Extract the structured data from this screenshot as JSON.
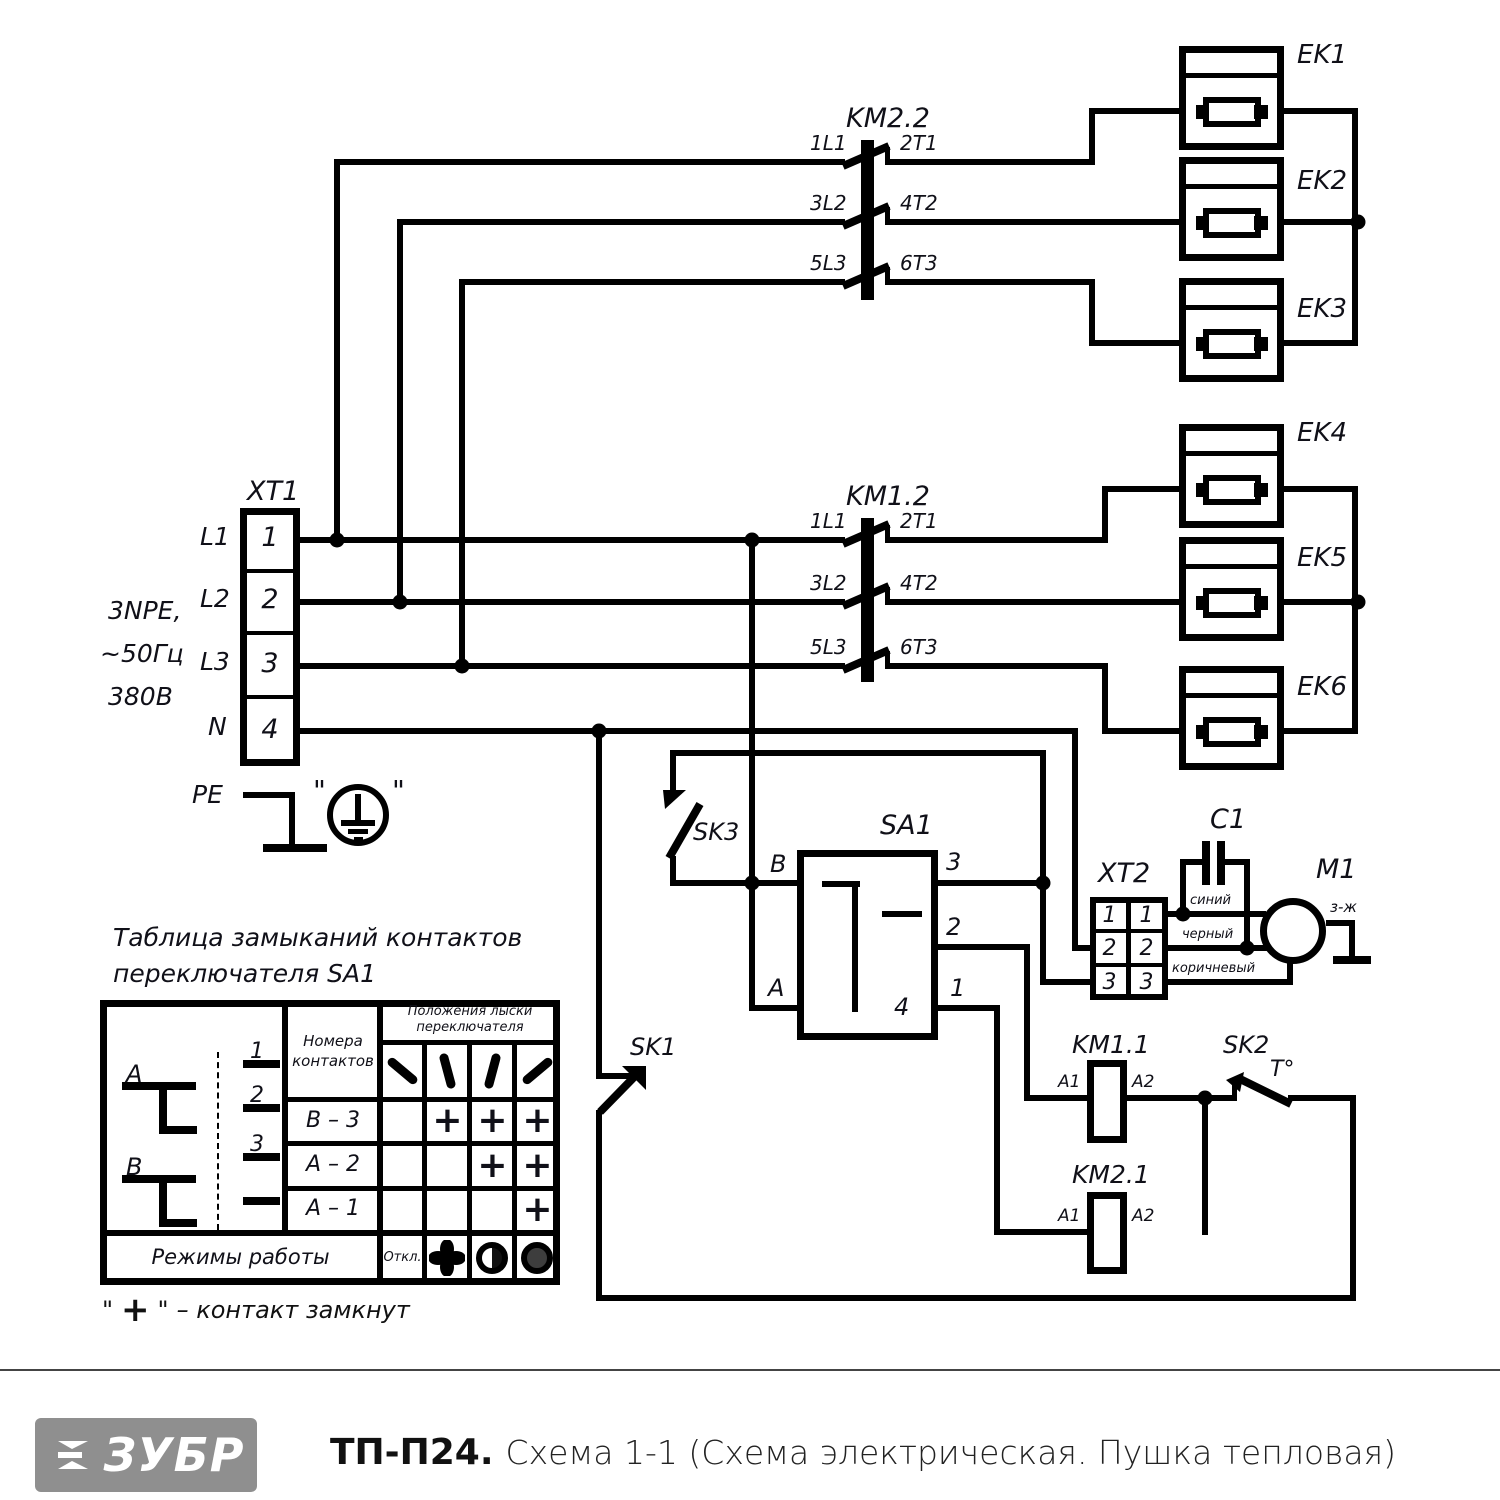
{
  "schematic": {
    "xt1": {
      "label": "XT1",
      "pe": "PE",
      "supply_lines": [
        "3NPE,",
        "~50Гц",
        "380В"
      ],
      "terminals": [
        {
          "phase": "L1",
          "num": "1"
        },
        {
          "phase": "L2",
          "num": "2"
        },
        {
          "phase": "L3",
          "num": "3"
        },
        {
          "phase": "N",
          "num": "4"
        }
      ]
    },
    "km22": {
      "label": "KM2.2",
      "contacts": [
        {
          "in": "1L1",
          "out": "2T1"
        },
        {
          "in": "3L2",
          "out": "4T2"
        },
        {
          "in": "5L3",
          "out": "6T3"
        }
      ]
    },
    "km12": {
      "label": "KM1.2",
      "contacts": [
        {
          "in": "1L1",
          "out": "2T1"
        },
        {
          "in": "3L2",
          "out": "4T2"
        },
        {
          "in": "5L3",
          "out": "6T3"
        }
      ]
    },
    "heaters": [
      "EK1",
      "EK2",
      "EK3",
      "EK4",
      "EK5",
      "EK6"
    ],
    "sa1": {
      "label": "SA1",
      "pin_b": "B",
      "pin_a": "A",
      "pin3": "3",
      "pin2": "2",
      "pin1": "1",
      "pin4": "4"
    },
    "sk1": {
      "label": "SK1"
    },
    "sk2": {
      "label": "SK2",
      "temp": "T°"
    },
    "sk3": {
      "label": "SK3"
    },
    "xt2": {
      "label": "XT2",
      "rows": [
        {
          "l": "1",
          "r": "1"
        },
        {
          "l": "2",
          "r": "2"
        },
        {
          "l": "3",
          "r": "3"
        }
      ],
      "wires": {
        "blue": "синий",
        "black": "черный",
        "brown": "коричневый",
        "earth": "з-ж"
      }
    },
    "c1": {
      "label": "C1"
    },
    "m1": {
      "label": "M1"
    },
    "km11": {
      "label": "KM1.1",
      "a1": "A1",
      "a2": "A2"
    },
    "km21": {
      "label": "KM2.1",
      "a1": "A1",
      "a2": "A2"
    }
  },
  "table": {
    "title_line1": "Таблица замыканий контактов",
    "title_line2": "переключателя SA1",
    "contacts_header_line1": "Номера",
    "contacts_header_line2": "контактов",
    "positions_header_line1": "Положения лыски",
    "positions_header_line2": "переключателя",
    "diagram": {
      "pole_a": "А",
      "pole_b": "В",
      "c1": "1",
      "c2": "2",
      "c3": "3"
    },
    "rows": [
      {
        "contacts": "В – 3",
        "cells": [
          "",
          "+",
          "+",
          "+"
        ]
      },
      {
        "contacts": "А – 2",
        "cells": [
          "",
          "",
          "+",
          "+"
        ]
      },
      {
        "contacts": "А – 1",
        "cells": [
          "",
          "",
          "",
          "+"
        ]
      }
    ],
    "modes_label": "Режимы работы",
    "off_label": "Откл."
  },
  "legend": {
    "quote_open": "\"",
    "plus": "+",
    "quote_close": "\"",
    "text": "– контакт замкнут"
  },
  "pe_quotes": {
    "left": "\"",
    "right": "\""
  },
  "footer": {
    "logo": "ЗУБР",
    "model": "ТП-П24.",
    "caption": "Схема 1-1 (Схема электрическая. Пушка тепловая)"
  }
}
